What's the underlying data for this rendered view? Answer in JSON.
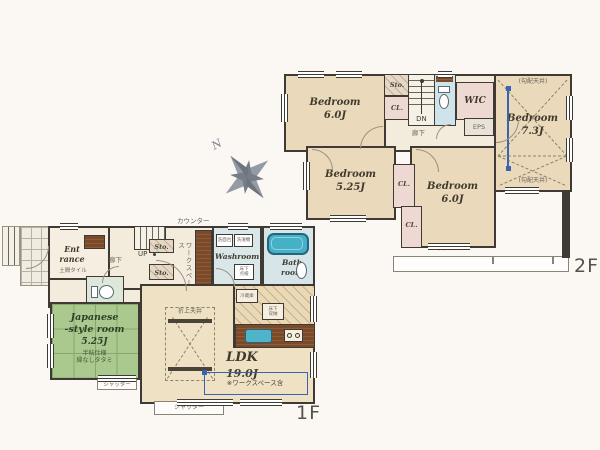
{
  "colors": {
    "wall": "#3f3a33",
    "tatami": "#aac98e",
    "tub": "#45b1c8",
    "annotation_blue": "#3a63af"
  },
  "compass": {
    "n": "N"
  },
  "floor2": {
    "label": "2F",
    "bedroom_tl": {
      "name": "Bedroom",
      "size": "6.0J"
    },
    "bedroom_r": {
      "name": "Bedroom",
      "size": "7.3J",
      "note_top": "(勾配天井)",
      "note_bottom": "(勾配天井)"
    },
    "bedroom_ml": {
      "name": "Bedroom",
      "size": "5.25J"
    },
    "bedroom_mr": {
      "name": "Bedroom",
      "size": "6.0J"
    },
    "sto": "Sto.",
    "cl_a": "CL.",
    "cl_b": "CL.",
    "cl_c": "CL.",
    "wic": "WIC",
    "eps": "EPS",
    "dn": "DN",
    "hallway": "廊下",
    "shutter": "シャッター"
  },
  "floor1": {
    "label": "1F",
    "entrance": {
      "line1": "Ent",
      "line2": "rance",
      "note": "土間タイル"
    },
    "hallway": "廊下",
    "up": "UP",
    "sto_a": "Sto.",
    "sto_b": "Sto.",
    "counter_label": "カウンター",
    "workspace_label": "ワークスペース",
    "washroom": {
      "name": "Washroom",
      "vanity": "洗面台",
      "washer": "洗濯機",
      "hatch": "床下点検"
    },
    "bathroom": {
      "line1": "Bath",
      "line2": "room"
    },
    "japanese": {
      "line1": "Japanese",
      "line2": "-style room",
      "size": "5.25J",
      "note1": "半帖仕様",
      "note2": "縁なしタタミ"
    },
    "ldk": {
      "name": "LDK",
      "size": "19.0J",
      "note": "※ワークスペース含",
      "coffered": "折上天井",
      "fridge": "冷蔵庫",
      "underfloor": "床下収納"
    },
    "shutter_left": "シャッター",
    "shutter_bottom": "シャッター"
  }
}
